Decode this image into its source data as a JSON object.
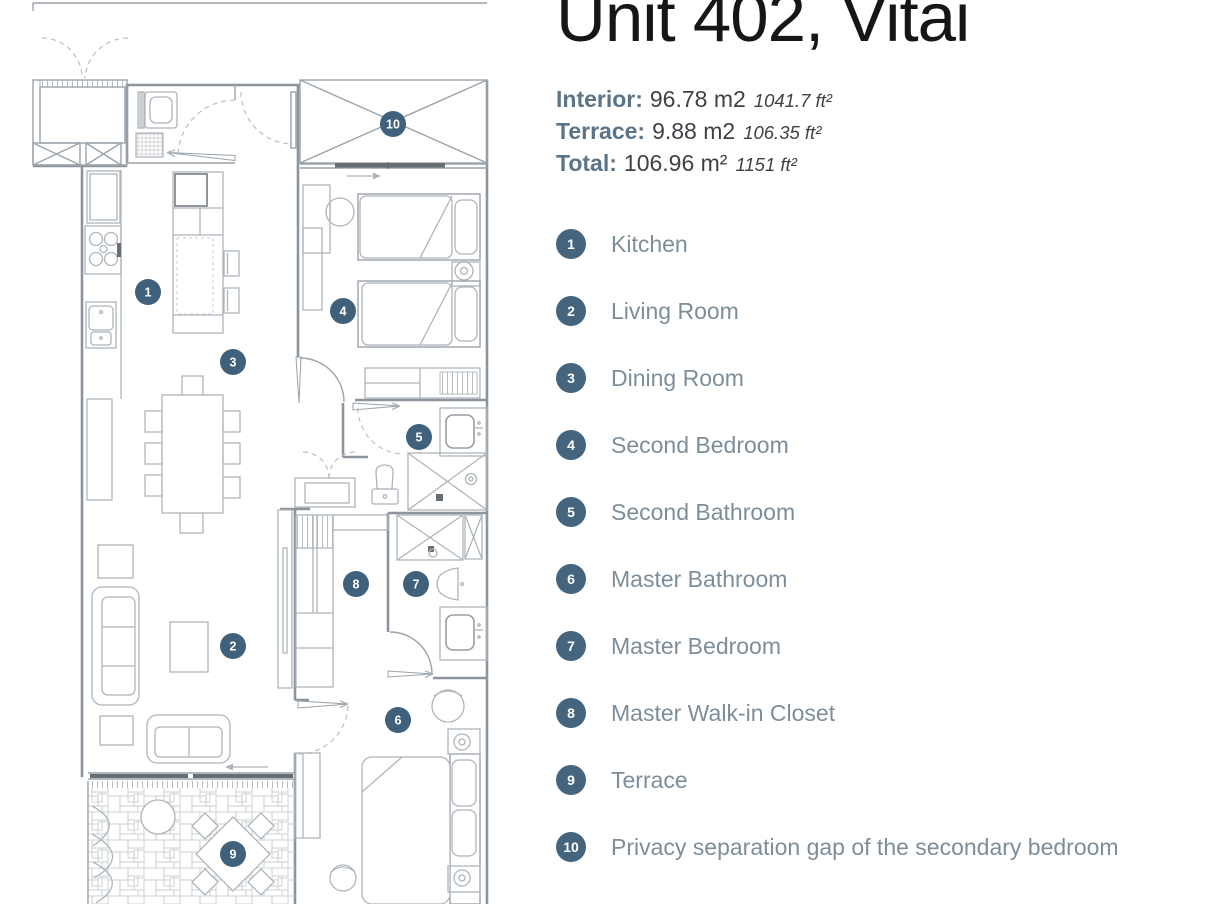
{
  "header": {
    "title": "Unit 402, Vitai"
  },
  "areas": {
    "interior": {
      "label": "Interior:",
      "metric": "96.78 m2",
      "imperial": "1041.7 ft²"
    },
    "terrace": {
      "label": "Terrace:",
      "metric": "9.88 m2",
      "imperial": "106.35 ft²"
    },
    "total": {
      "label": "Total:",
      "metric": "106.96 m²",
      "imperial": "1151 ft²"
    }
  },
  "legend": {
    "items": [
      {
        "number": "1",
        "label": "Kitchen"
      },
      {
        "number": "2",
        "label": "Living Room"
      },
      {
        "number": "3",
        "label": "Dining Room"
      },
      {
        "number": "4",
        "label": "Second Bedroom"
      },
      {
        "number": "5",
        "label": "Second Bathroom"
      },
      {
        "number": "6",
        "label": "Master Bathroom"
      },
      {
        "number": "7",
        "label": "Master Bedroom"
      },
      {
        "number": "8",
        "label": "Master Walk-in Closet"
      },
      {
        "number": "9",
        "label": "Terrace"
      },
      {
        "number": "10",
        "label": "Privacy separation gap of the secondary bedroom"
      }
    ]
  },
  "plan": {
    "markers": [
      {
        "number": "1",
        "x": 148,
        "y": 292
      },
      {
        "number": "2",
        "x": 233,
        "y": 646
      },
      {
        "number": "3",
        "x": 233,
        "y": 362
      },
      {
        "number": "4",
        "x": 343,
        "y": 311
      },
      {
        "number": "5",
        "x": 419,
        "y": 437
      },
      {
        "number": "6",
        "x": 398,
        "y": 720
      },
      {
        "number": "7",
        "x": 416,
        "y": 584
      },
      {
        "number": "8",
        "x": 356,
        "y": 584
      },
      {
        "number": "9",
        "x": 233,
        "y": 854
      },
      {
        "number": "10",
        "x": 393,
        "y": 124
      }
    ]
  },
  "colors": {
    "accent_badge": "#45657F",
    "plan_marker": "#3F617B",
    "legend_label": "#7E8E99",
    "stat_label": "#5C7487",
    "value_text": "#3E4246",
    "title_text": "#161616"
  }
}
